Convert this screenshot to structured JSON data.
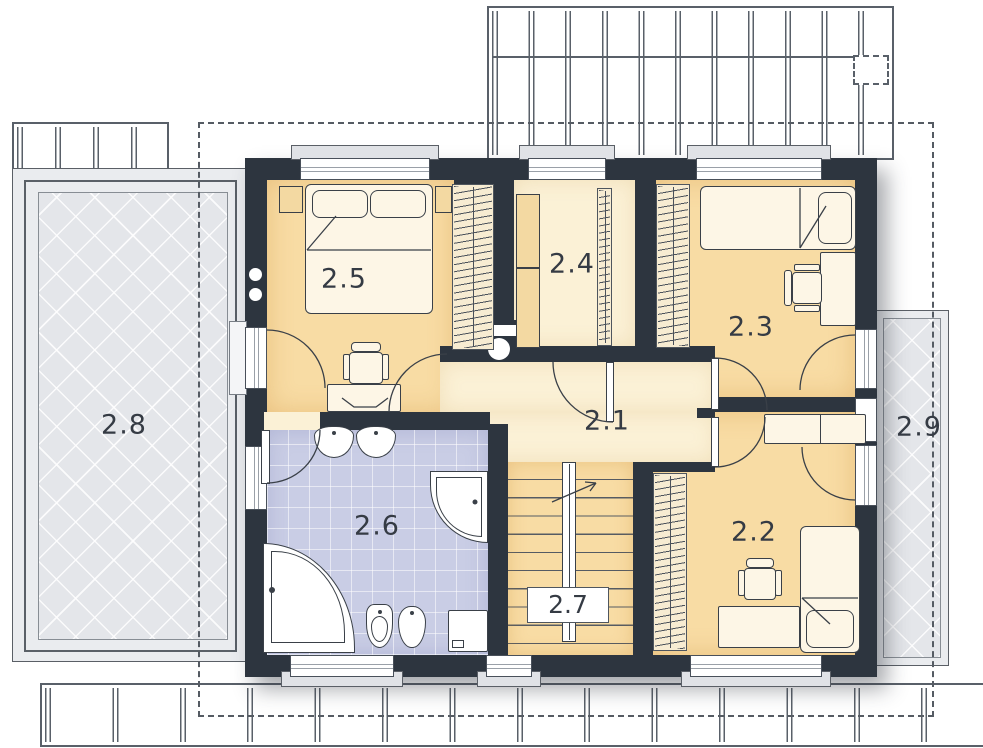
{
  "rooms": [
    {
      "id": "2.1",
      "label": "2.1"
    },
    {
      "id": "2.2",
      "label": "2.2"
    },
    {
      "id": "2.3",
      "label": "2.3"
    },
    {
      "id": "2.4",
      "label": "2.4"
    },
    {
      "id": "2.5",
      "label": "2.5"
    },
    {
      "id": "2.6",
      "label": "2.6"
    },
    {
      "id": "2.7",
      "label": "2.7"
    },
    {
      "id": "2.8",
      "label": "2.8"
    },
    {
      "id": "2.9",
      "label": "2.9"
    }
  ],
  "colors": {
    "wall": "#2d353f",
    "room_tan": "#f8dca4",
    "room_cream": "#fbf1d6",
    "bath_tile": "#c9cde5",
    "terrace_gray": "#e4e6ea",
    "line": "#3a4048"
  },
  "fixtures": [
    "double-bed",
    "single-bed",
    "wardrobe-rail",
    "desk",
    "chair",
    "bathtub",
    "corner-shower",
    "washbasin",
    "toilet",
    "bidet",
    "washer-cabinet",
    "staircase",
    "chimney-flue",
    "pergola",
    "terrace",
    "balcony",
    "roof-outline"
  ]
}
